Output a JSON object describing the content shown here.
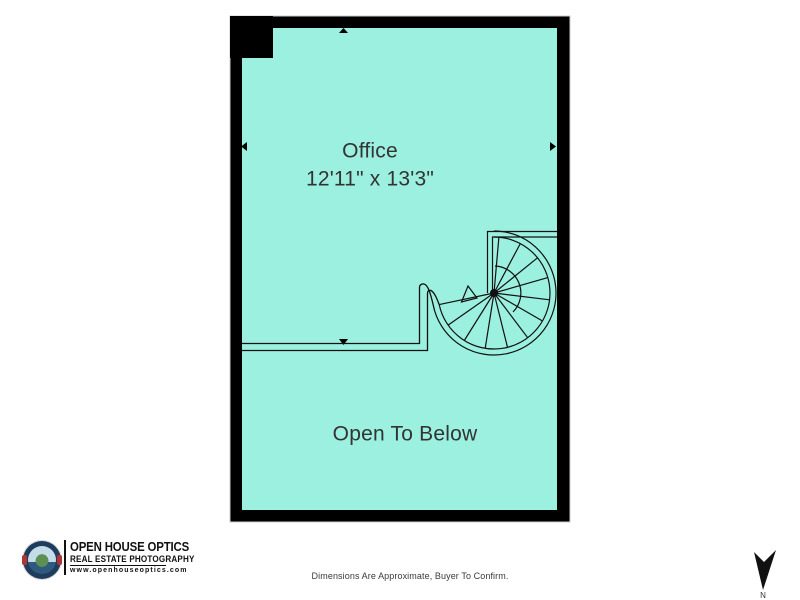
{
  "canvas": {
    "width": 800,
    "height": 600,
    "background": "#ffffff"
  },
  "floor_plan": {
    "fill_color": "#9BF0DF",
    "wall_color": "#000000",
    "rooms": [
      {
        "label": "Office",
        "dimensions": "12'11\" x 13'3\""
      },
      {
        "label": "Open To Below",
        "dimensions": ""
      }
    ],
    "features": [
      "spiral-staircase",
      "half-wall-railing",
      "wall-direction-markers"
    ]
  },
  "branding": {
    "company_name": "OPEN HOUSE OPTICS",
    "tagline": "REAL ESTATE PHOTOGRAPHY",
    "website": "www.openhouseoptics.com"
  },
  "footer": {
    "disclaimer": "Dimensions Are Approximate, Buyer To Confirm."
  },
  "compass": {
    "label": "N"
  }
}
